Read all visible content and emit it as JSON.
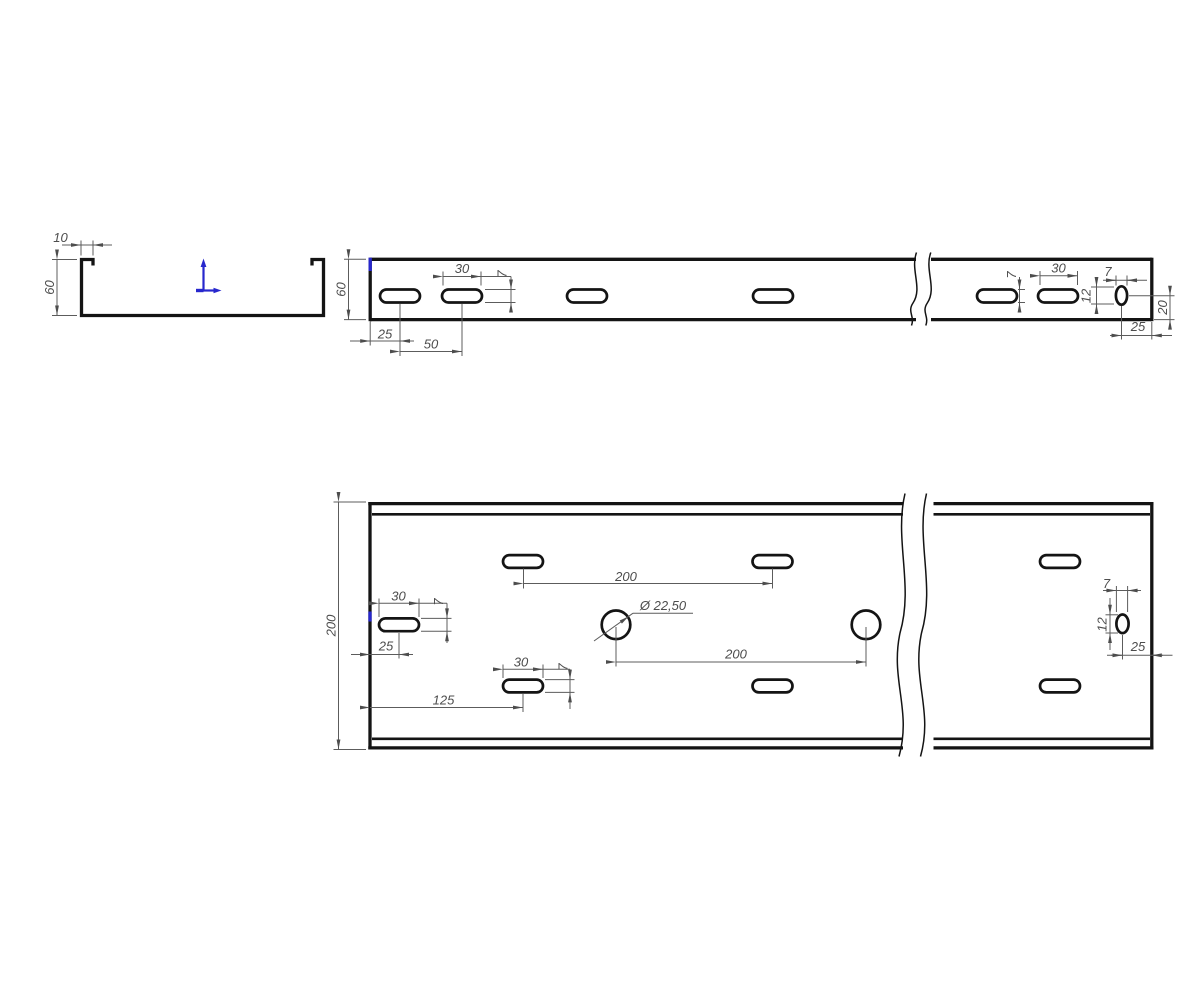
{
  "drawing": {
    "colors": {
      "line": "#141414",
      "dim": "#5c5c5c",
      "dim_text": "#4d4d4d",
      "accent_blue": "#2727cd",
      "background": "#ffffff"
    },
    "icons": {
      "ucs": "axes-icon"
    },
    "section_view": {
      "lip_width": "10",
      "height": "60"
    },
    "side_view": {
      "height": "60",
      "slot_length": "30",
      "slot_width": "7",
      "edge_to_first_slot": "25",
      "slot_pitch": "50",
      "right_slot_width": "7",
      "right_slot_length": "30",
      "end_slot_width": "7",
      "end_slot_height": "12",
      "end_slot_to_bottom": "20",
      "end_slot_offset": "25"
    },
    "plan_view": {
      "width": "200",
      "top_slot_pitch": "200",
      "left_slot_length": "30",
      "left_slot_width": "7",
      "left_slot_offset": "25",
      "mid_slot_from_edge": "125",
      "mid_slot_length": "30",
      "mid_slot_width": "7",
      "hole_diameter": "Ø 22,50",
      "hole_pitch": "200",
      "end_slot_width": "7",
      "end_slot_height": "12",
      "end_slot_offset": "25"
    }
  }
}
